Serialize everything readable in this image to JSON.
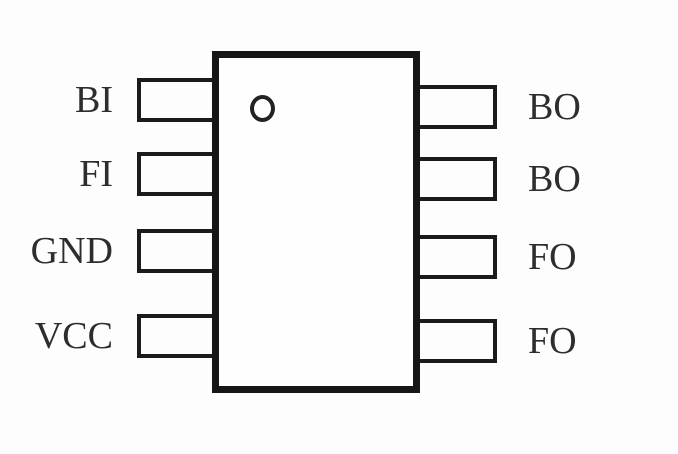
{
  "pinout": {
    "package": "8-pin IC (top view)",
    "pin1_marker_icon": "circle-dot-icon",
    "left_pins": [
      "BI",
      "FI",
      "GND",
      "VCC"
    ],
    "right_pins": [
      "BO",
      "BO",
      "FO",
      "FO"
    ],
    "colors": {
      "line": "#1b1b1b",
      "body_border": "#161616",
      "background": "#fdfdfd",
      "text": "#2d2d2d"
    }
  }
}
